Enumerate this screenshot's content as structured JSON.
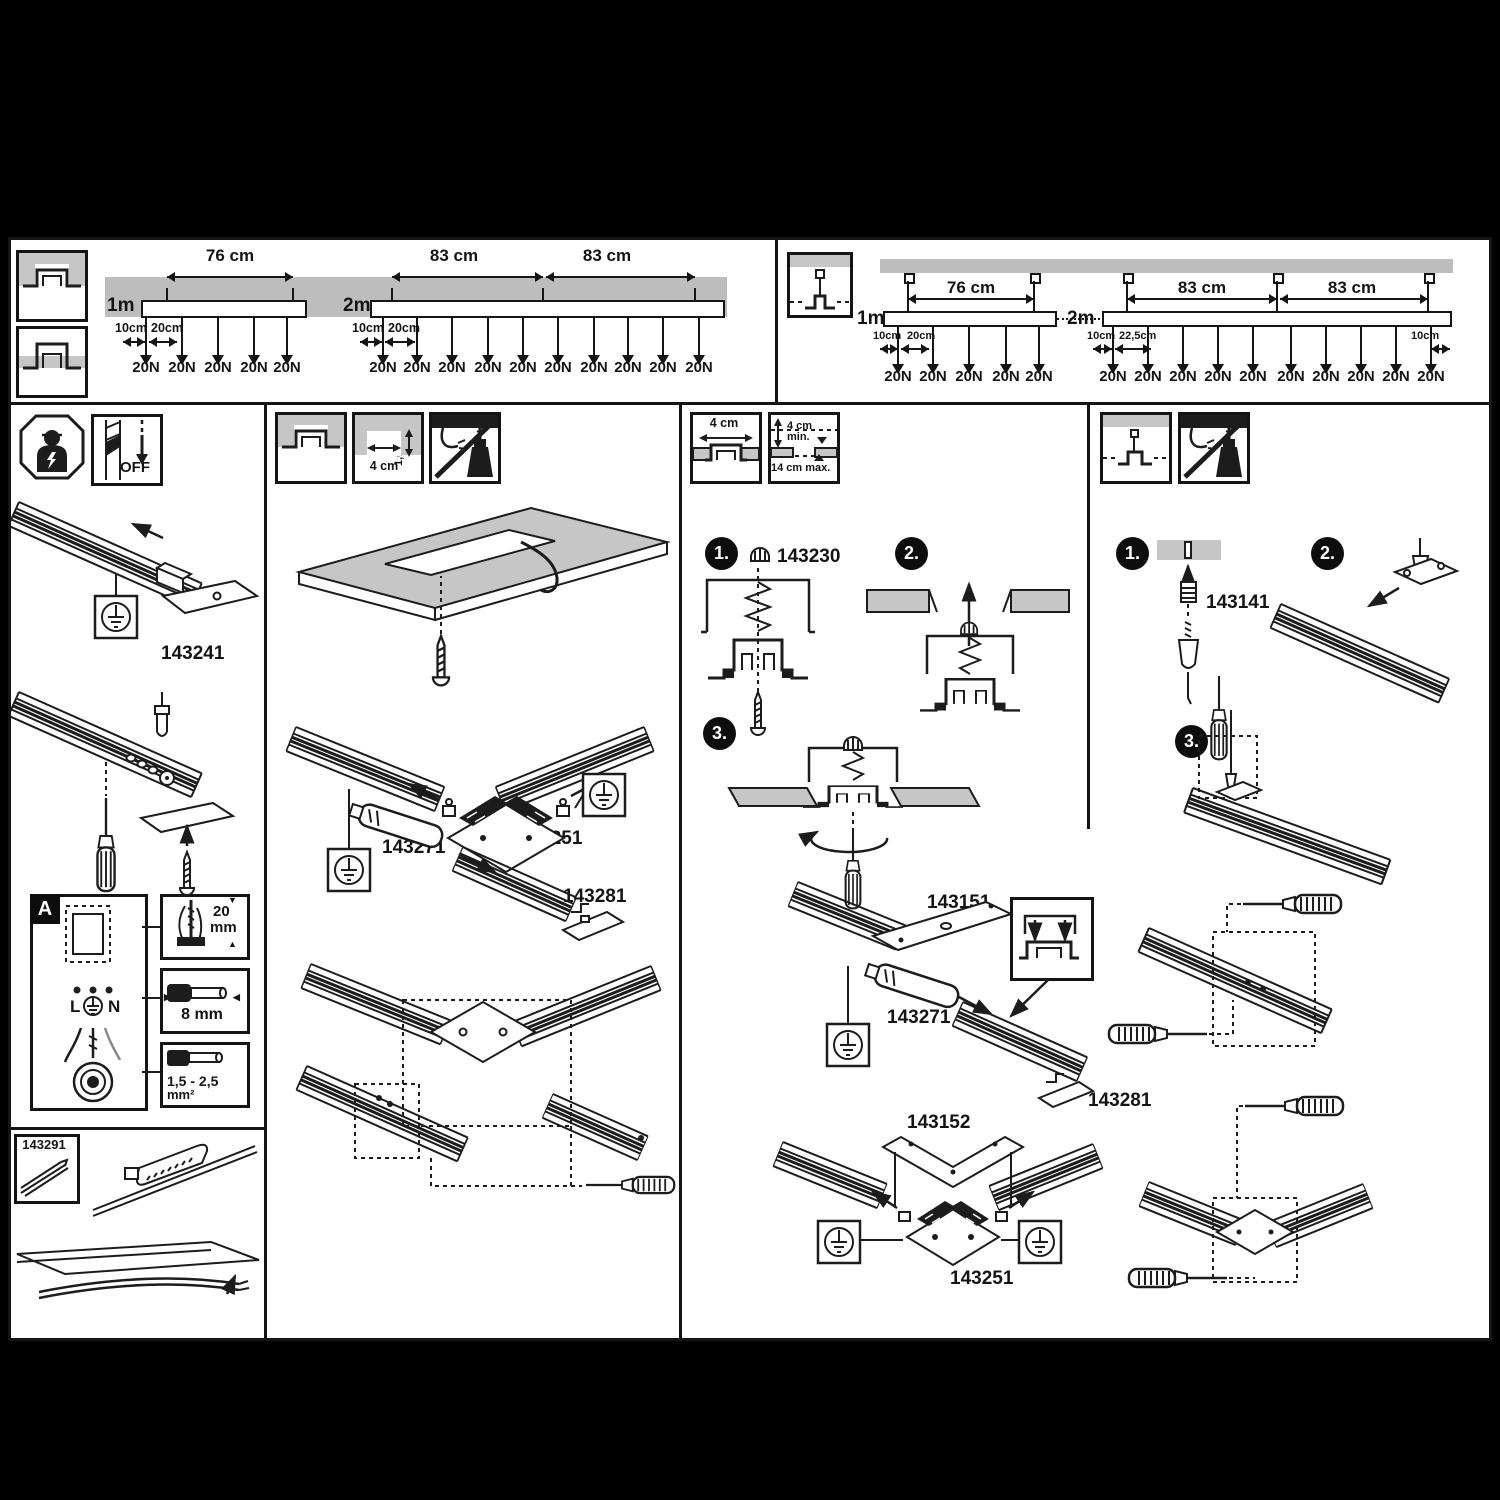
{
  "document": {
    "type": "track-lighting mounting instructions"
  },
  "colors": {
    "letterbox": "#000000",
    "paper": "#ffffff",
    "ink": "#141414",
    "ceiling_gray": "#bdbdbd"
  },
  "load": {
    "force": "20N",
    "recessed": {
      "m1": {
        "len": "1m",
        "span": "76 cm",
        "edge": "10cm",
        "gap": "20cm",
        "forces": 5
      },
      "m2": {
        "len": "2m",
        "span_a": "83 cm",
        "span_b": "83 cm",
        "edge": "10cm",
        "gap": "20cm",
        "forces": 10
      }
    },
    "suspended": {
      "m1": {
        "len": "1m",
        "span": "76 cm",
        "edge": "10cm",
        "gap": "20cm",
        "forces": 5
      },
      "m2": {
        "len": "2m",
        "span_a": "83 cm",
        "span_b": "83 cm",
        "edge": "10cm",
        "gap": "22,5cm",
        "edge_r": "10cm",
        "forces": 10
      }
    }
  },
  "wiring": {
    "off": "OFF",
    "part_feed": "143241",
    "marker": "A",
    "term_l": "L",
    "term_n": "N",
    "strip_val": "20",
    "strip_unit": "mm",
    "ferrule": "8 mm",
    "cross_a": "1,5 - 2,5",
    "cross_b": "mm²",
    "part_profile": "143291"
  },
  "recessed_install": {
    "slot_w": "4 cm",
    "slot_d": "1,6 cm",
    "part_corner": "143251",
    "part_conn": "143271",
    "part_end": "143281"
  },
  "clamp_install": {
    "slot_w": "4 cm",
    "d_min": "4 cm",
    "d_min2": "min.",
    "d_max": "14 cm max.",
    "s1": "1.",
    "s2": "2.",
    "s3": "3.",
    "part_clamp": "143230",
    "part_plate": "143151",
    "part_conn": "143271",
    "part_end": "143281",
    "part_plate_l": "143152",
    "part_corner": "143251"
  },
  "suspend_install": {
    "s1": "1.",
    "s2": "2.",
    "s3": "3.",
    "part_wire": "143141"
  }
}
